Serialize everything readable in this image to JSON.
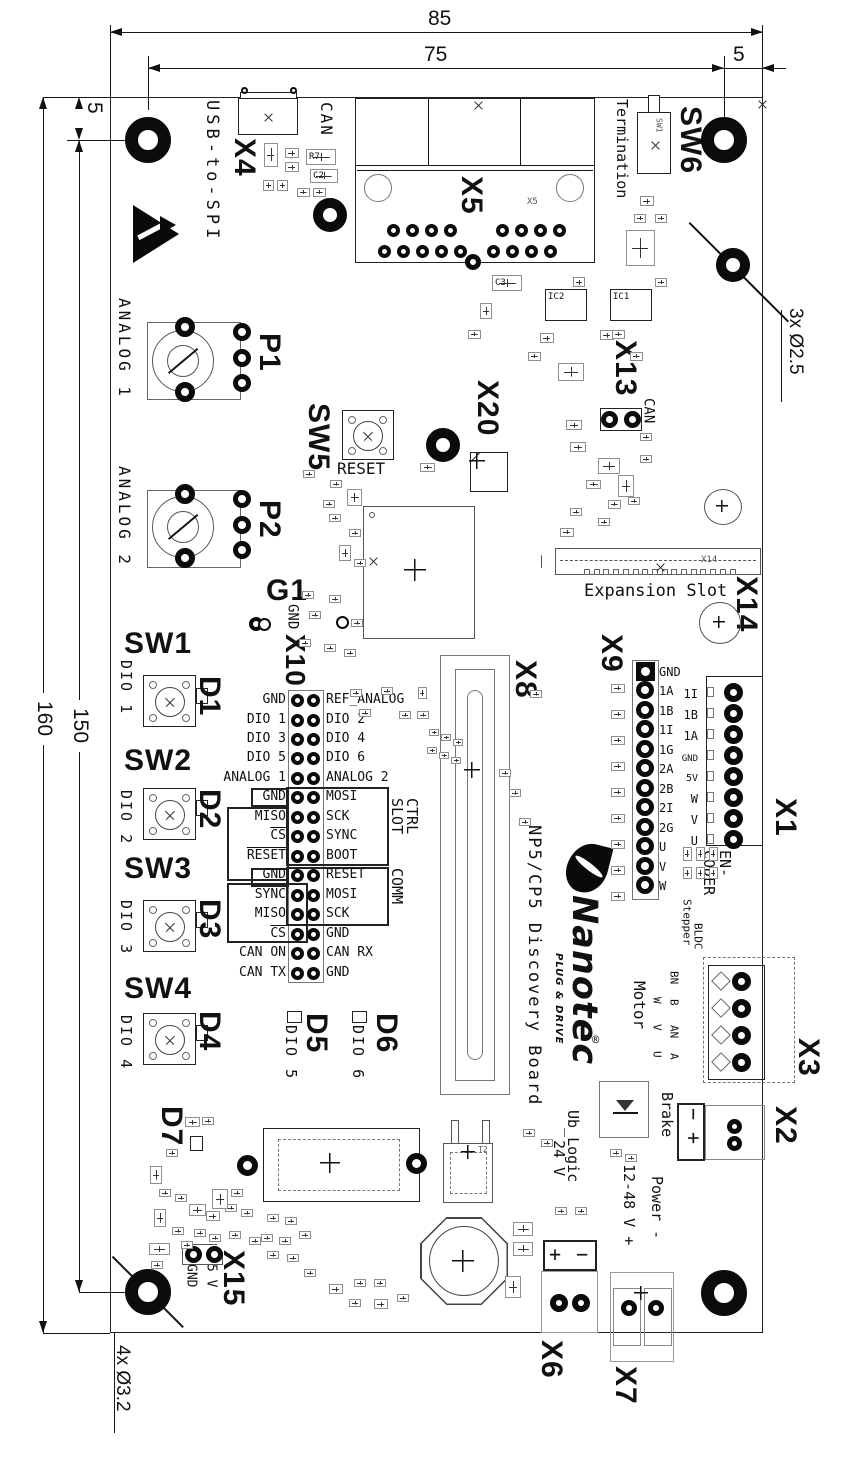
{
  "drawing": {
    "title": "NP5/CP5 Discovery Board",
    "brand": {
      "name": "Nanotec",
      "tagline": "PLUG & DRIVE",
      "reg": "®"
    }
  },
  "dimensions": {
    "board_width": "85",
    "hole_span_top": "75",
    "gap_top_right": "5",
    "gap_top_left": "5",
    "board_height": "160",
    "hole_span_left": "150",
    "mount_holes": "4x Ø3.2",
    "small_holes": "3x Ø2.5"
  },
  "connectors": {
    "x1": {
      "ref": "X1",
      "label_line1": "EN-",
      "label_line2": "CODER",
      "pins": [
        "1I",
        "1B",
        "1A",
        "GND",
        "5V",
        "W",
        "V",
        "U"
      ]
    },
    "x2": {
      "ref": "X2",
      "label": "Brake",
      "pin_minus": "−",
      "pin_plus": "+"
    },
    "x3": {
      "ref": "X3",
      "label": "Motor",
      "stepper_header": "Stepper",
      "stepper_pins": [
        "BN",
        "B",
        "AN",
        "A"
      ],
      "bldc_header": "BLDC",
      "bldc_pins": [
        "W",
        "V",
        "U"
      ]
    },
    "x4": {
      "ref": "X4",
      "label": "USB-to-SPI",
      "can_label": "CAN"
    },
    "x5": {
      "ref": "X5",
      "small_ref": "X5"
    },
    "x6": {
      "ref": "X6",
      "label_line1": "Ub_Logic",
      "label_line2": "24 V",
      "plus": "+",
      "minus": "−"
    },
    "x7": {
      "ref": "X7",
      "label_line1": "Power -",
      "label_line2": "12-48 V +"
    },
    "x8": {
      "ref": "X8"
    },
    "x9": {
      "ref": "X9",
      "pins": [
        "GND",
        "1A",
        "1B",
        "1I",
        "1G",
        "2A",
        "2B",
        "2I",
        "2G",
        "U",
        "V",
        "W"
      ]
    },
    "x10": {
      "ref": "X10",
      "group_ctrl_line1": "CTRL",
      "group_ctrl_line2": "SLOT",
      "group_comm": "COMM",
      "rows": [
        {
          "l": "GND",
          "r": "REF_ANALOG"
        },
        {
          "l": "DIO 1",
          "r": "DIO 2"
        },
        {
          "l": "DIO 3",
          "r": "DIO 4"
        },
        {
          "l": "DIO 5",
          "r": "DIO 6"
        },
        {
          "l": "ANALOG 1",
          "r": "ANALOG 2"
        },
        {
          "l": "GND",
          "r": "MOSI"
        },
        {
          "l": "MISO",
          "r": "SCK"
        },
        {
          "l": "CS",
          "r": "SYNC"
        },
        {
          "l": "RESET",
          "r": "BOOT"
        },
        {
          "l": "GND",
          "r": "RESET"
        },
        {
          "l": "SYNC",
          "r": "MOSI"
        },
        {
          "l": "MISO",
          "r": "SCK"
        },
        {
          "l": "CS",
          "r": "GND"
        },
        {
          "l": "CAN ON",
          "r": "CAN RX"
        },
        {
          "l": "CAN TX",
          "r": "GND"
        }
      ]
    },
    "x13": {
      "ref": "X13",
      "label": "CAN"
    },
    "x14": {
      "ref": "X14",
      "label": "Expansion Slot",
      "small_ref": "X14"
    },
    "x15": {
      "ref": "X15",
      "pin_gnd": "GND",
      "pin_5v": "5 V"
    },
    "x20": {
      "ref": "X20"
    }
  },
  "buttons": {
    "sw1": {
      "ref": "SW1",
      "signal": "DIO 1"
    },
    "sw2": {
      "ref": "SW2",
      "signal": "DIO 2"
    },
    "sw3": {
      "ref": "SW3",
      "signal": "DIO 3"
    },
    "sw4": {
      "ref": "SW4",
      "signal": "DIO 4"
    },
    "sw5": {
      "ref": "SW5",
      "signal": "RESET"
    },
    "sw6": {
      "ref": "SW6",
      "signal": "Termination"
    }
  },
  "leds": {
    "d1": {
      "ref": "D1"
    },
    "d2": {
      "ref": "D2"
    },
    "d3": {
      "ref": "D3"
    },
    "d4": {
      "ref": "D4"
    },
    "d5": {
      "ref": "D5",
      "signal": "DIO 5"
    },
    "d6": {
      "ref": "D6",
      "signal": "DIO 6"
    },
    "d7": {
      "ref": "D7"
    }
  },
  "potentiometers": {
    "p1": {
      "ref": "P1",
      "label": "ANALOG 1"
    },
    "p2": {
      "ref": "P2",
      "label": "ANALOG 2"
    }
  },
  "test_points": {
    "g1": {
      "ref": "G1",
      "label": "GND"
    }
  },
  "small_refdes": {
    "r7": "R7",
    "c2": "C2",
    "c3": "C3",
    "ic1": "IC1",
    "ic2": "IC2",
    "t2": "T2",
    "sw_term": "SW1"
  }
}
